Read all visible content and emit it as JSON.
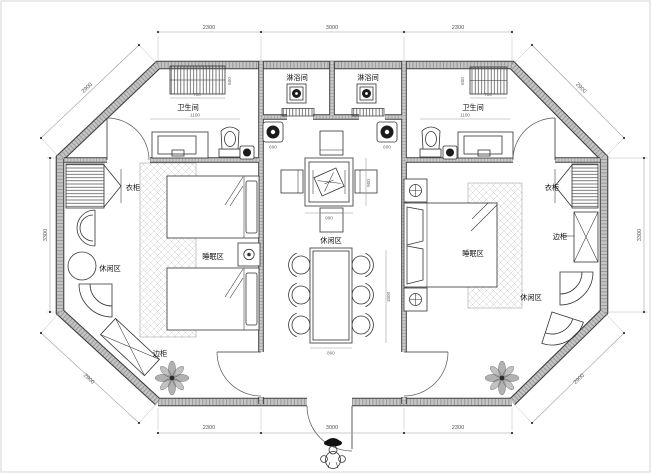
{
  "labels": {
    "shower_left": "淋浴间",
    "shower_right": "淋浴间",
    "bathroom_left": "卫生间",
    "bathroom_right": "卫生间",
    "wardrobe_left": "衣柜",
    "wardrobe_right": "衣柜",
    "sleep_left": "睡眠区",
    "sleep_right": "睡眠区",
    "leisure_left": "休闲区",
    "leisure_center": "休闲区",
    "leisure_right": "休闲区",
    "cabinet_left": "边柜",
    "cabinet_right": "边柜"
  },
  "dims": {
    "top": [
      "2300",
      "3000",
      "2300"
    ],
    "bottom": [
      "2300",
      "3000",
      "2300"
    ],
    "side_left": "3300",
    "side_right": "3300",
    "diag_tl": "2900",
    "diag_tr": "2900",
    "diag_bl": "2900",
    "diag_br": "2900",
    "shelf_left_w": "700",
    "shelf_right_w": "700",
    "shelf_left_d": "600",
    "shelf_right_d": "600",
    "bath_left_w": "1100",
    "bath_right_w": "1100",
    "basin_left": "600",
    "basin_right": "600",
    "square_w": "900",
    "square_d": "900",
    "dining_w": "800",
    "dining_l": "1800"
  },
  "colors": {
    "wall_fill": "#c4c4c4",
    "wall_edge": "#3f3f3f",
    "line": "#333333",
    "dim_text": "#555555",
    "fixture_dark": "#1c1c1c"
  }
}
